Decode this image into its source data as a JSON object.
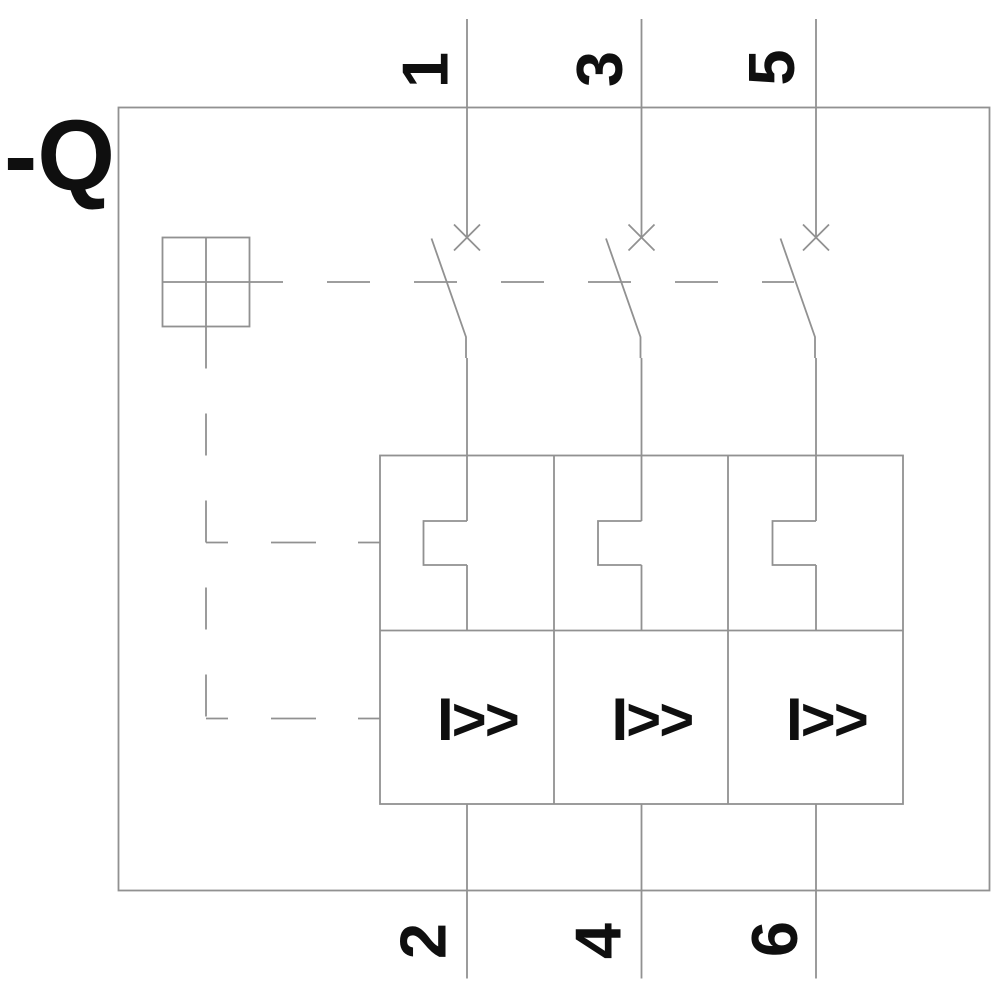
{
  "component": {
    "label": "-Q"
  },
  "terminals": {
    "top": [
      "1",
      "3",
      "5"
    ],
    "bottom": [
      "2",
      "4",
      "6"
    ]
  },
  "symbols": {
    "magnetic_trip": "I>>",
    "icons": [
      "x-contact-icon",
      "switch-blade-icon",
      "operator-square-cross-icon",
      "thermal-overload-step-icon",
      "mechanical-linkage-dashed-line"
    ]
  },
  "colors": {
    "line_gray": "#919191",
    "ink_black": "#0f0f0f",
    "background": "#ffffff"
  }
}
